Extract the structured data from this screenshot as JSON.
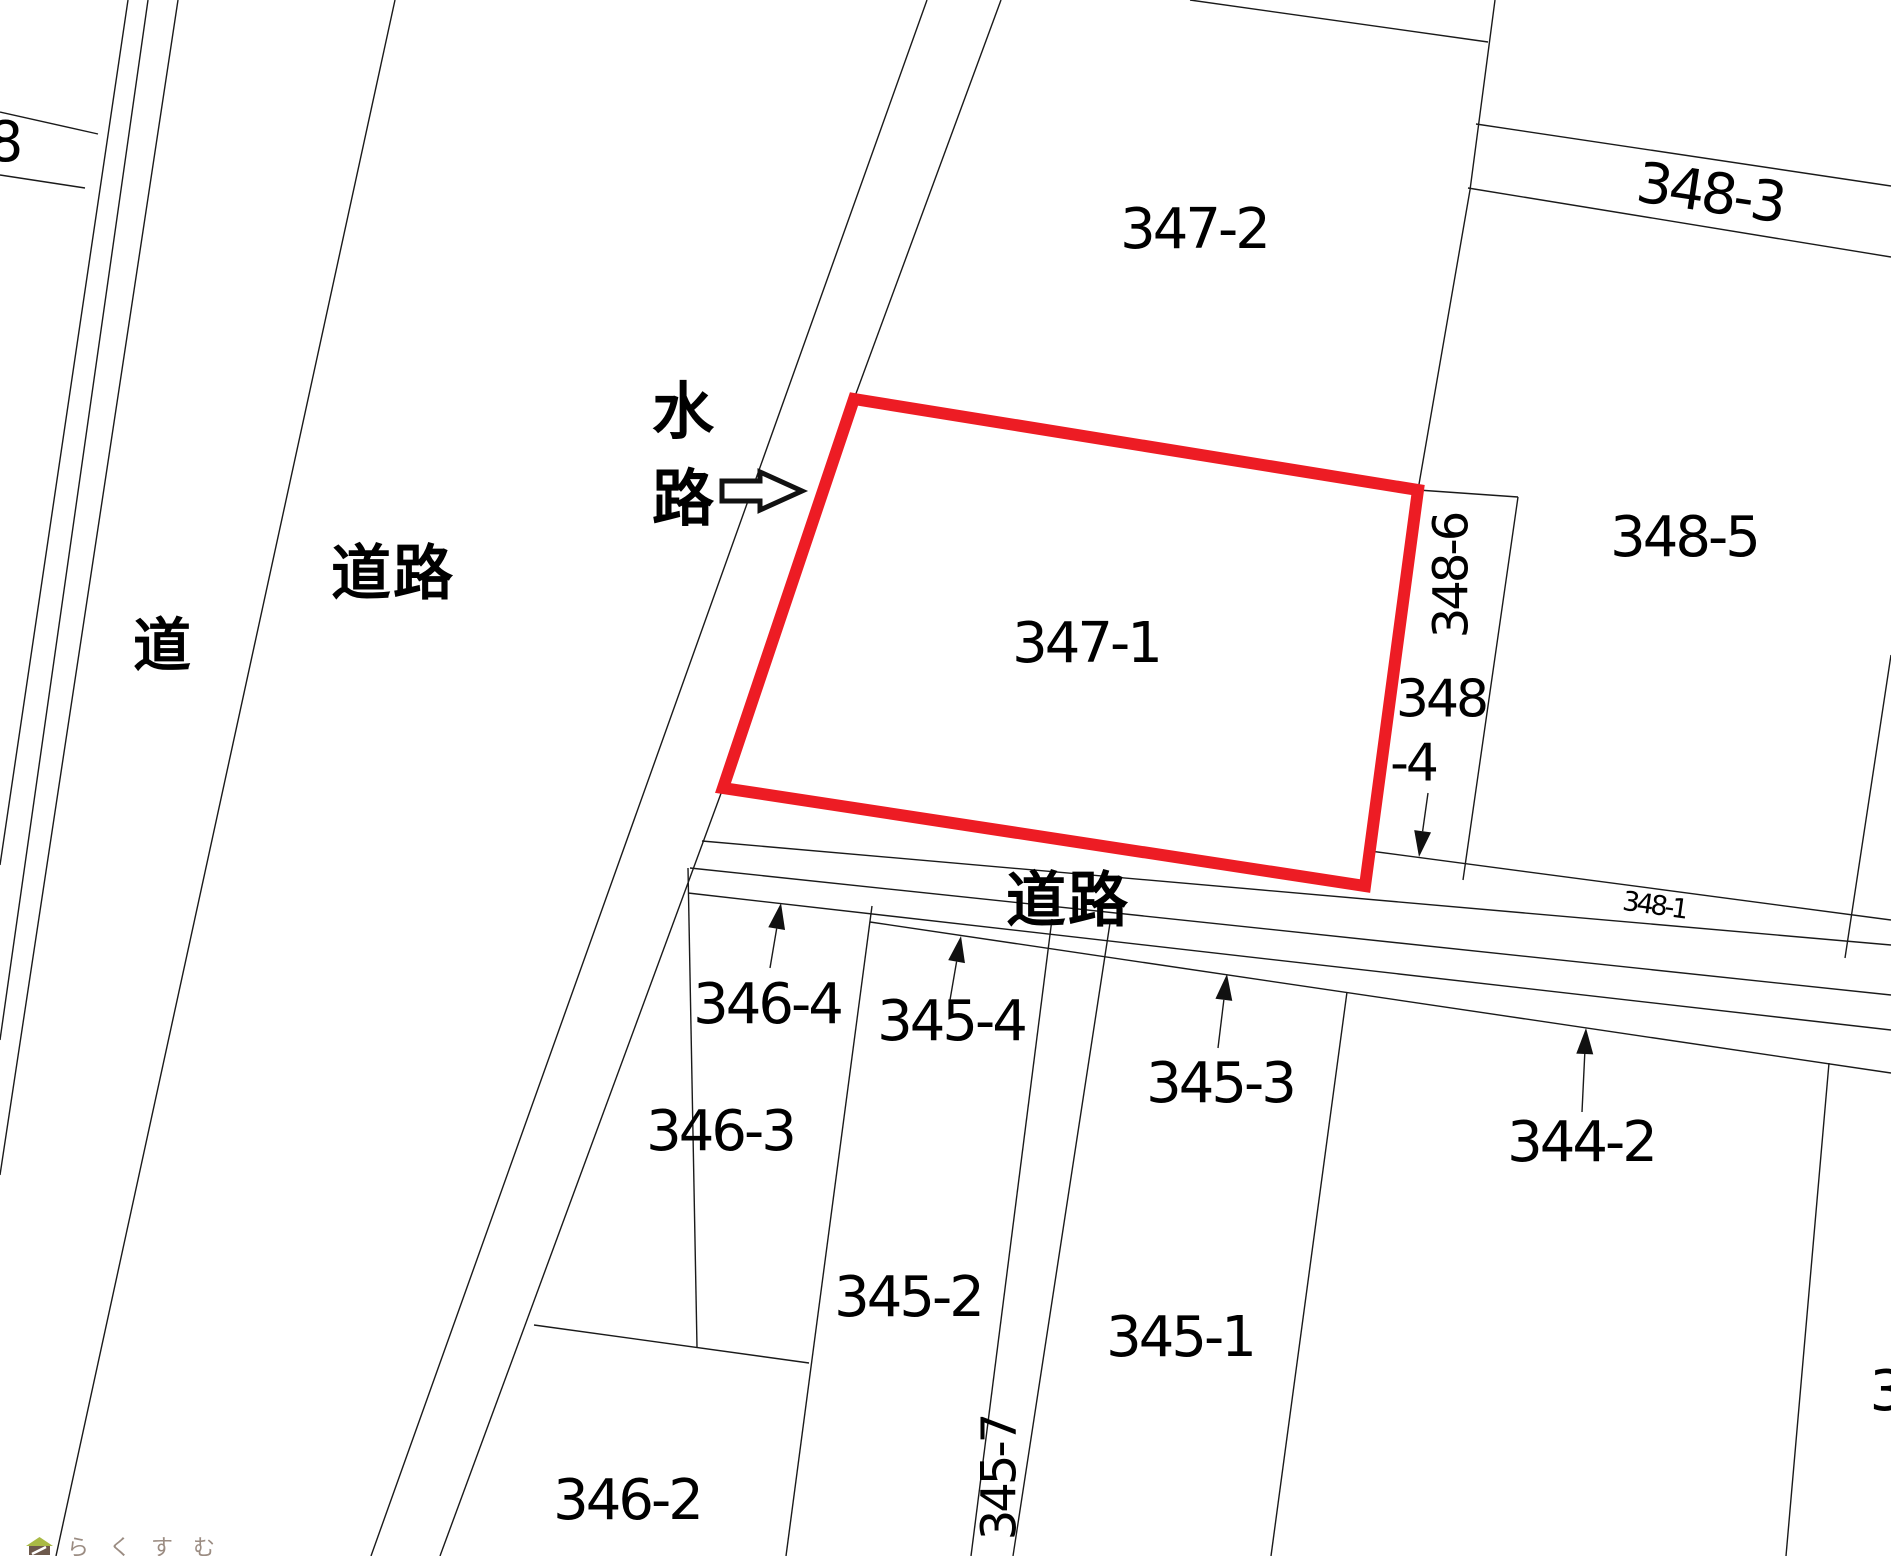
{
  "map": {
    "type": "cadastral-parcel-map",
    "background": "#ffffff",
    "line_color": "#1a1a1a",
    "highlight": {
      "parcel": "347-1",
      "color": "#ed1c24",
      "stroke_width": 12,
      "points": "854,399 1418,490 1365,886 723,788"
    },
    "labels": [
      {
        "name": "parcel-label-8",
        "text": "8",
        "x": 4,
        "y": 143,
        "size": 56
      },
      {
        "name": "road-label-douro-left",
        "text": "道路",
        "x": 393,
        "y": 574,
        "size": 60,
        "cjk": true
      },
      {
        "name": "road-label-michi",
        "text": "道",
        "x": 163,
        "y": 646,
        "size": 58,
        "cjk": true
      },
      {
        "name": "waterway-label",
        "text": "水路",
        "x": 684,
        "y": 456,
        "size": 62,
        "cjk": true,
        "vertical": true
      },
      {
        "name": "parcel-label-347-2",
        "text": "347-2",
        "x": 1194,
        "y": 230,
        "size": 56
      },
      {
        "name": "parcel-label-347-1",
        "text": "347-1",
        "x": 1086,
        "y": 644,
        "size": 56
      },
      {
        "name": "parcel-label-348-3",
        "text": "348-3",
        "x": 1710,
        "y": 194,
        "size": 56,
        "rotate": 8.5
      },
      {
        "name": "parcel-label-348-5",
        "text": "348-5",
        "x": 1684,
        "y": 538,
        "size": 56
      },
      {
        "name": "parcel-label-348-6",
        "text": "348-6",
        "x": 1452,
        "y": 576,
        "size": 48,
        "rotate": -90
      },
      {
        "name": "parcel-label-348-4-line1",
        "text": "348",
        "x": 1441,
        "y": 700,
        "size": 52
      },
      {
        "name": "parcel-label-348-4-line2",
        "text": "-4",
        "x": 1413,
        "y": 764,
        "size": 52
      },
      {
        "name": "parcel-label-348-1",
        "text": "348-1",
        "x": 1654,
        "y": 906,
        "size": 27,
        "rotate": 8
      },
      {
        "name": "road-label-douro-bottom",
        "text": "道路",
        "x": 1068,
        "y": 901,
        "size": 60,
        "cjk": true
      },
      {
        "name": "parcel-label-346-4",
        "text": "346-4",
        "x": 767,
        "y": 1005,
        "size": 56
      },
      {
        "name": "parcel-label-345-4",
        "text": "345-4",
        "x": 951,
        "y": 1022,
        "size": 56
      },
      {
        "name": "parcel-label-346-3",
        "text": "346-3",
        "x": 720,
        "y": 1132,
        "size": 56
      },
      {
        "name": "parcel-label-345-3",
        "text": "345-3",
        "x": 1220,
        "y": 1084,
        "size": 56
      },
      {
        "name": "parcel-label-344-2",
        "text": "344-2",
        "x": 1581,
        "y": 1143,
        "size": 56
      },
      {
        "name": "parcel-label-345-2",
        "text": "345-2",
        "x": 908,
        "y": 1298,
        "size": 56
      },
      {
        "name": "parcel-label-345-1",
        "text": "345-1",
        "x": 1180,
        "y": 1338,
        "size": 56
      },
      {
        "name": "parcel-label-345-7",
        "text": "345-7",
        "x": 1000,
        "y": 1478,
        "size": 48,
        "rotate": -90
      },
      {
        "name": "parcel-label-346-2",
        "text": "346-2",
        "x": 627,
        "y": 1501,
        "size": 56
      },
      {
        "name": "parcel-label-3-partial",
        "text": "3",
        "x": 1886,
        "y": 1392,
        "size": 56
      }
    ],
    "pointer_arrows": [
      {
        "name": "arrow-to-346-4",
        "x1": 770,
        "y1": 968,
        "x2": 781,
        "y2": 903
      },
      {
        "name": "arrow-to-345-4",
        "x1": 950,
        "y1": 1000,
        "x2": 961,
        "y2": 936
      },
      {
        "name": "arrow-to-345-3",
        "x1": 1218,
        "y1": 1048,
        "x2": 1227,
        "y2": 974
      },
      {
        "name": "arrow-to-344-2",
        "x1": 1582,
        "y1": 1112,
        "x2": 1586,
        "y2": 1028
      },
      {
        "name": "arrow-to-348-4",
        "x1": 1428,
        "y1": 793,
        "x2": 1419,
        "y2": 857
      }
    ],
    "waterway_pointer": {
      "style": "outline-right-arrow",
      "points": "722,481 760,481 760,472 802,491 760,510 760,501 722,501",
      "stroke_width": 5
    },
    "watermark": {
      "text": "らくすむ",
      "icon": "house-icon",
      "text_color": "#9b8c82",
      "roof_color": "#a9ba45",
      "body_color": "#6d594c"
    }
  }
}
